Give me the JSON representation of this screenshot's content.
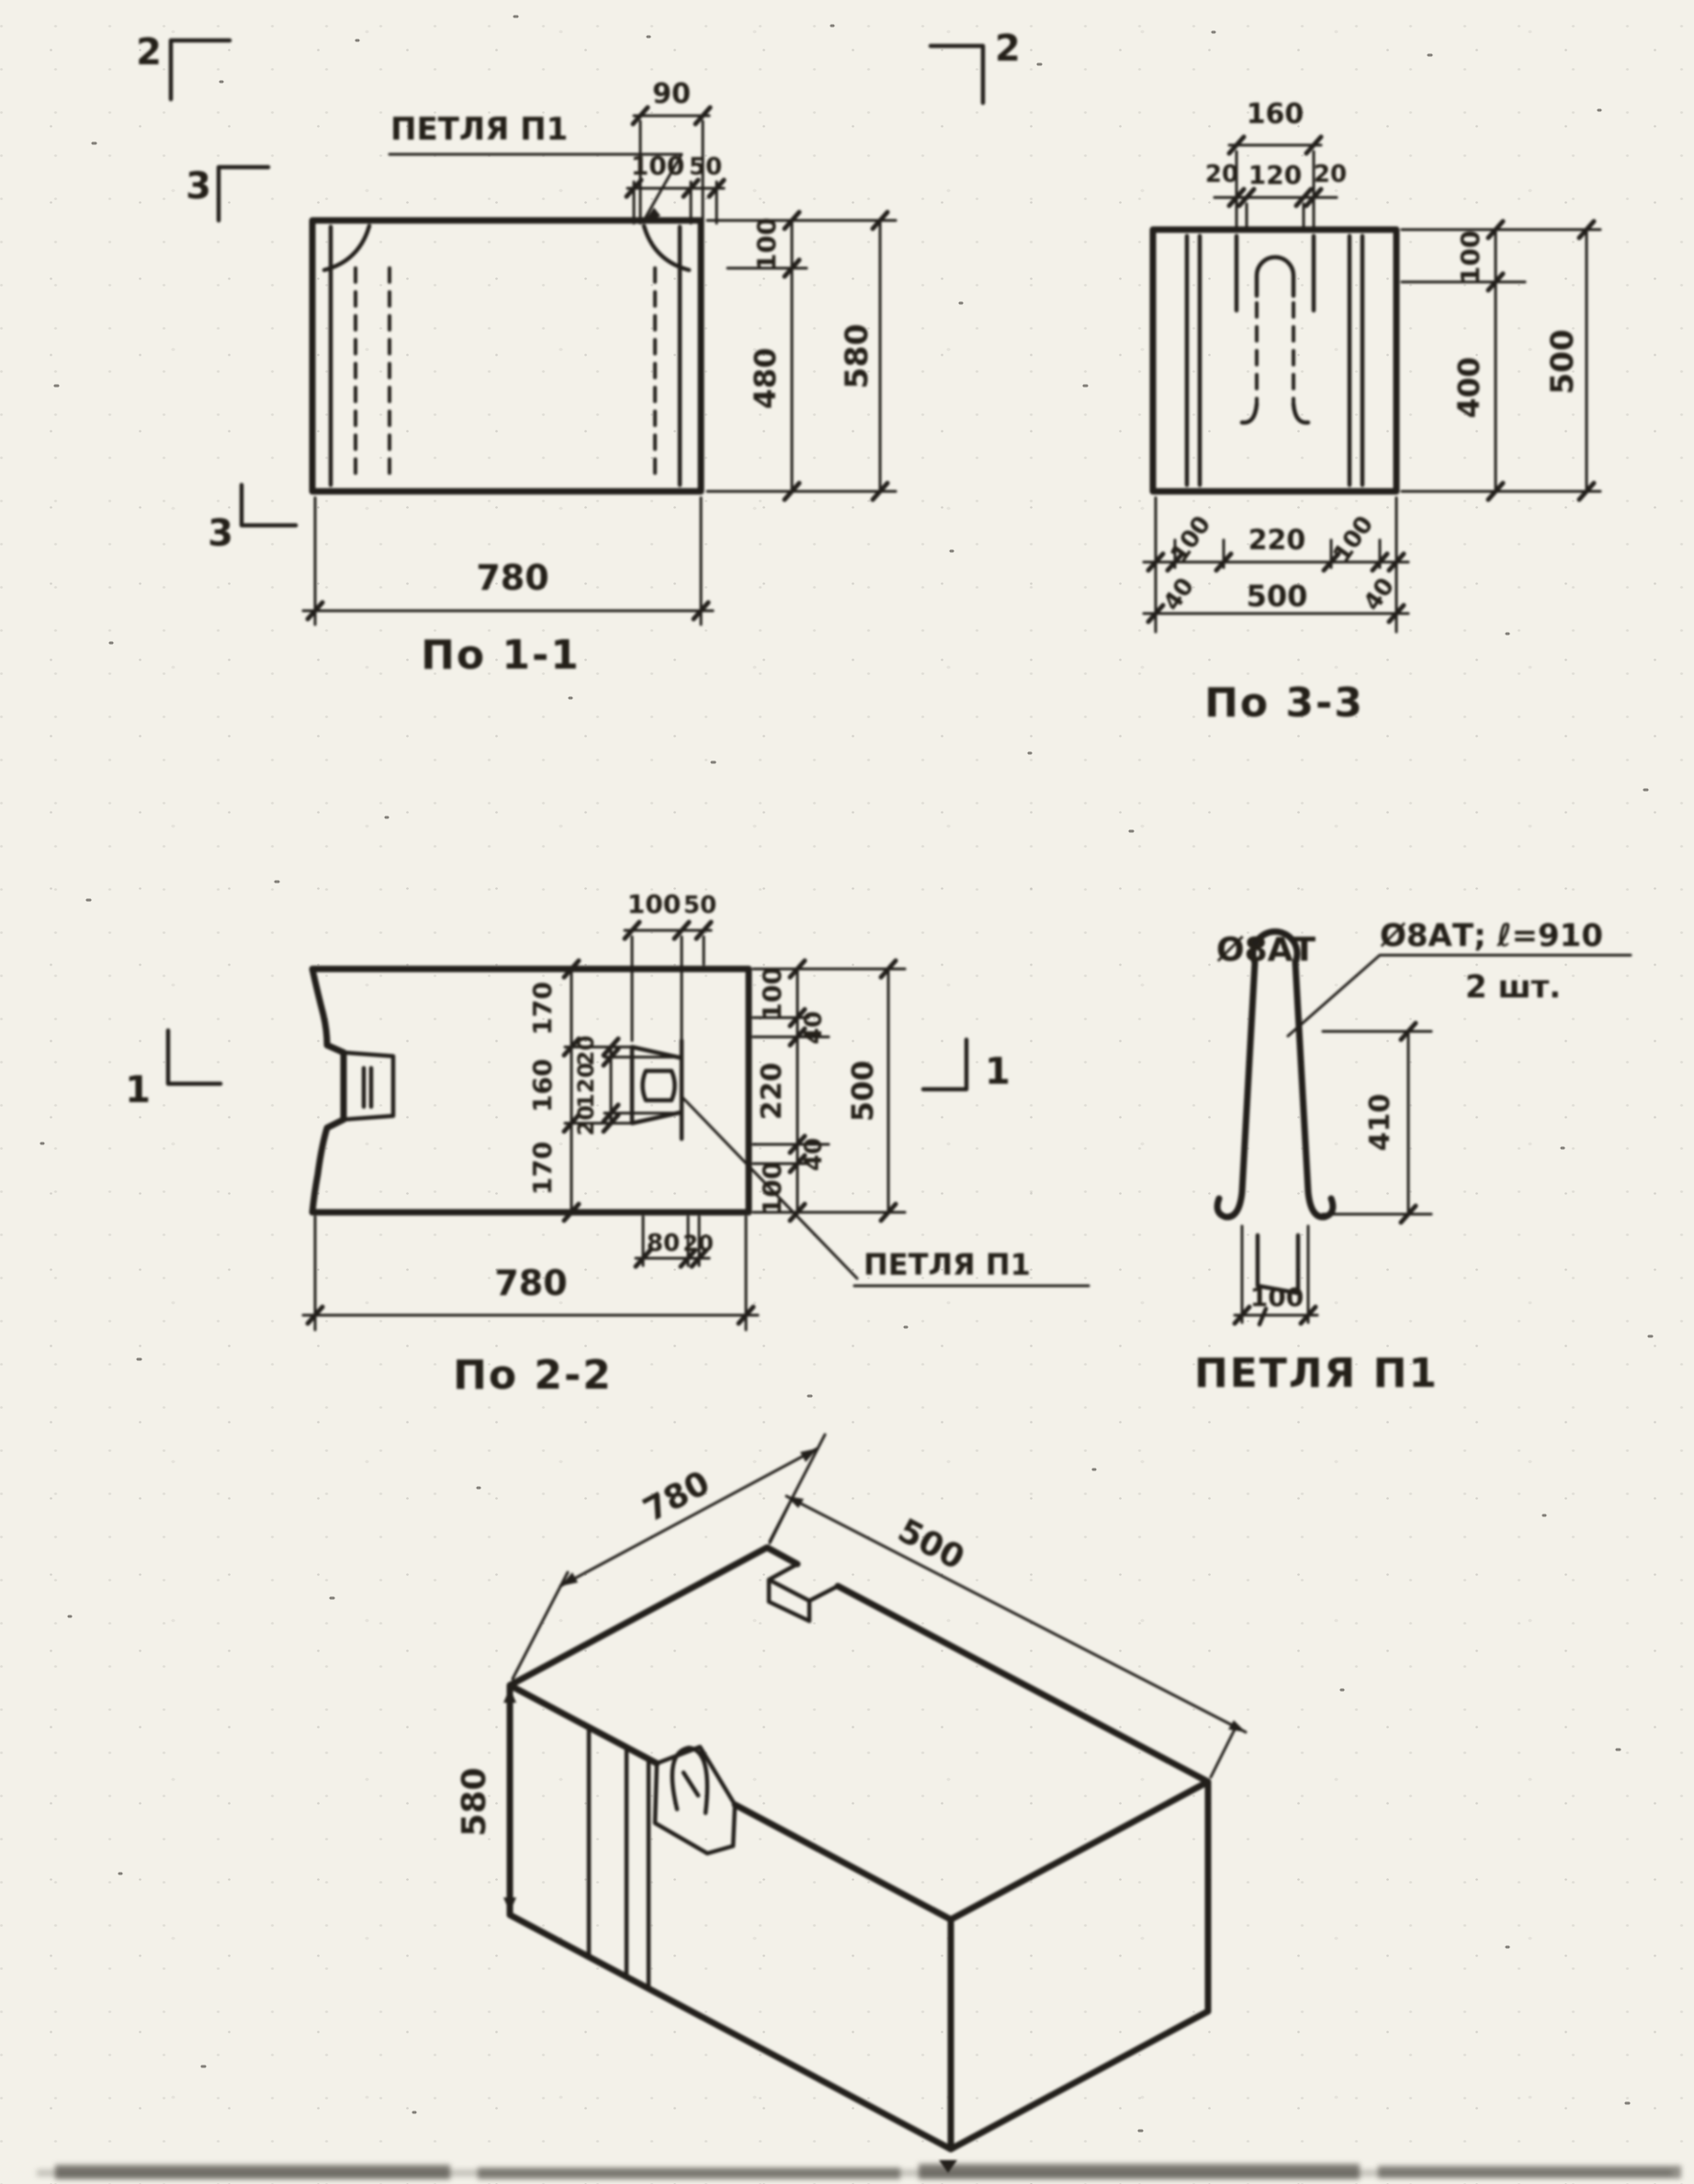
{
  "drawing": {
    "paper_color": "#f3f1e9",
    "ink_color": "#221f1b"
  },
  "section_1_1": {
    "caption": "По 1-1",
    "loop_label": "ПЕТЛЯ П1",
    "dim_top_90": "90",
    "dim_top_100": "100",
    "dim_top_50": "50",
    "dim_right_100": "100",
    "dim_right_480": "480",
    "dim_right_580": "580",
    "dim_bottom_780": "780",
    "mark_2_left": "2",
    "mark_2_right": "2",
    "mark_3_top": "3",
    "mark_3_bottom": "3"
  },
  "section_3_3": {
    "caption": "По 3-3",
    "dim_top_160": "160",
    "dim_top_20l": "20",
    "dim_top_120": "120",
    "dim_top_20r": "20",
    "dim_right_100": "100",
    "dim_right_400": "400",
    "dim_right_500": "500",
    "dim_bot_100l": "100",
    "dim_bot_220": "220",
    "dim_bot_100r": "100",
    "dim_bot_40l": "40",
    "dim_bot_40r": "40",
    "dim_bot_500": "500"
  },
  "section_2_2": {
    "caption": "По 2-2",
    "loop_label": "ПЕТЛЯ П1",
    "dim_top_100": "100",
    "dim_top_50": "50",
    "left_chain": [
      "170",
      "160",
      "170"
    ],
    "inner_chain": [
      "20",
      "120",
      "20"
    ],
    "right_chain": [
      "100",
      "40",
      "220",
      "40",
      "100"
    ],
    "dim_right_500": "500",
    "dim_bot_80": "80",
    "dim_bot_20": "20",
    "dim_bottom_780": "780",
    "mark_1_left": "1",
    "mark_1_right": "1"
  },
  "loop_detail": {
    "caption": "ПЕТЛЯ П1",
    "apex_label": "Ø8АТ",
    "note_line1": "Ø8АТ; ℓ=910",
    "note_line2": "2 шт.",
    "dim_height_410": "410",
    "dim_width_100": "100"
  },
  "isometric": {
    "dim_780": "780",
    "dim_500": "500",
    "dim_580": "580"
  }
}
